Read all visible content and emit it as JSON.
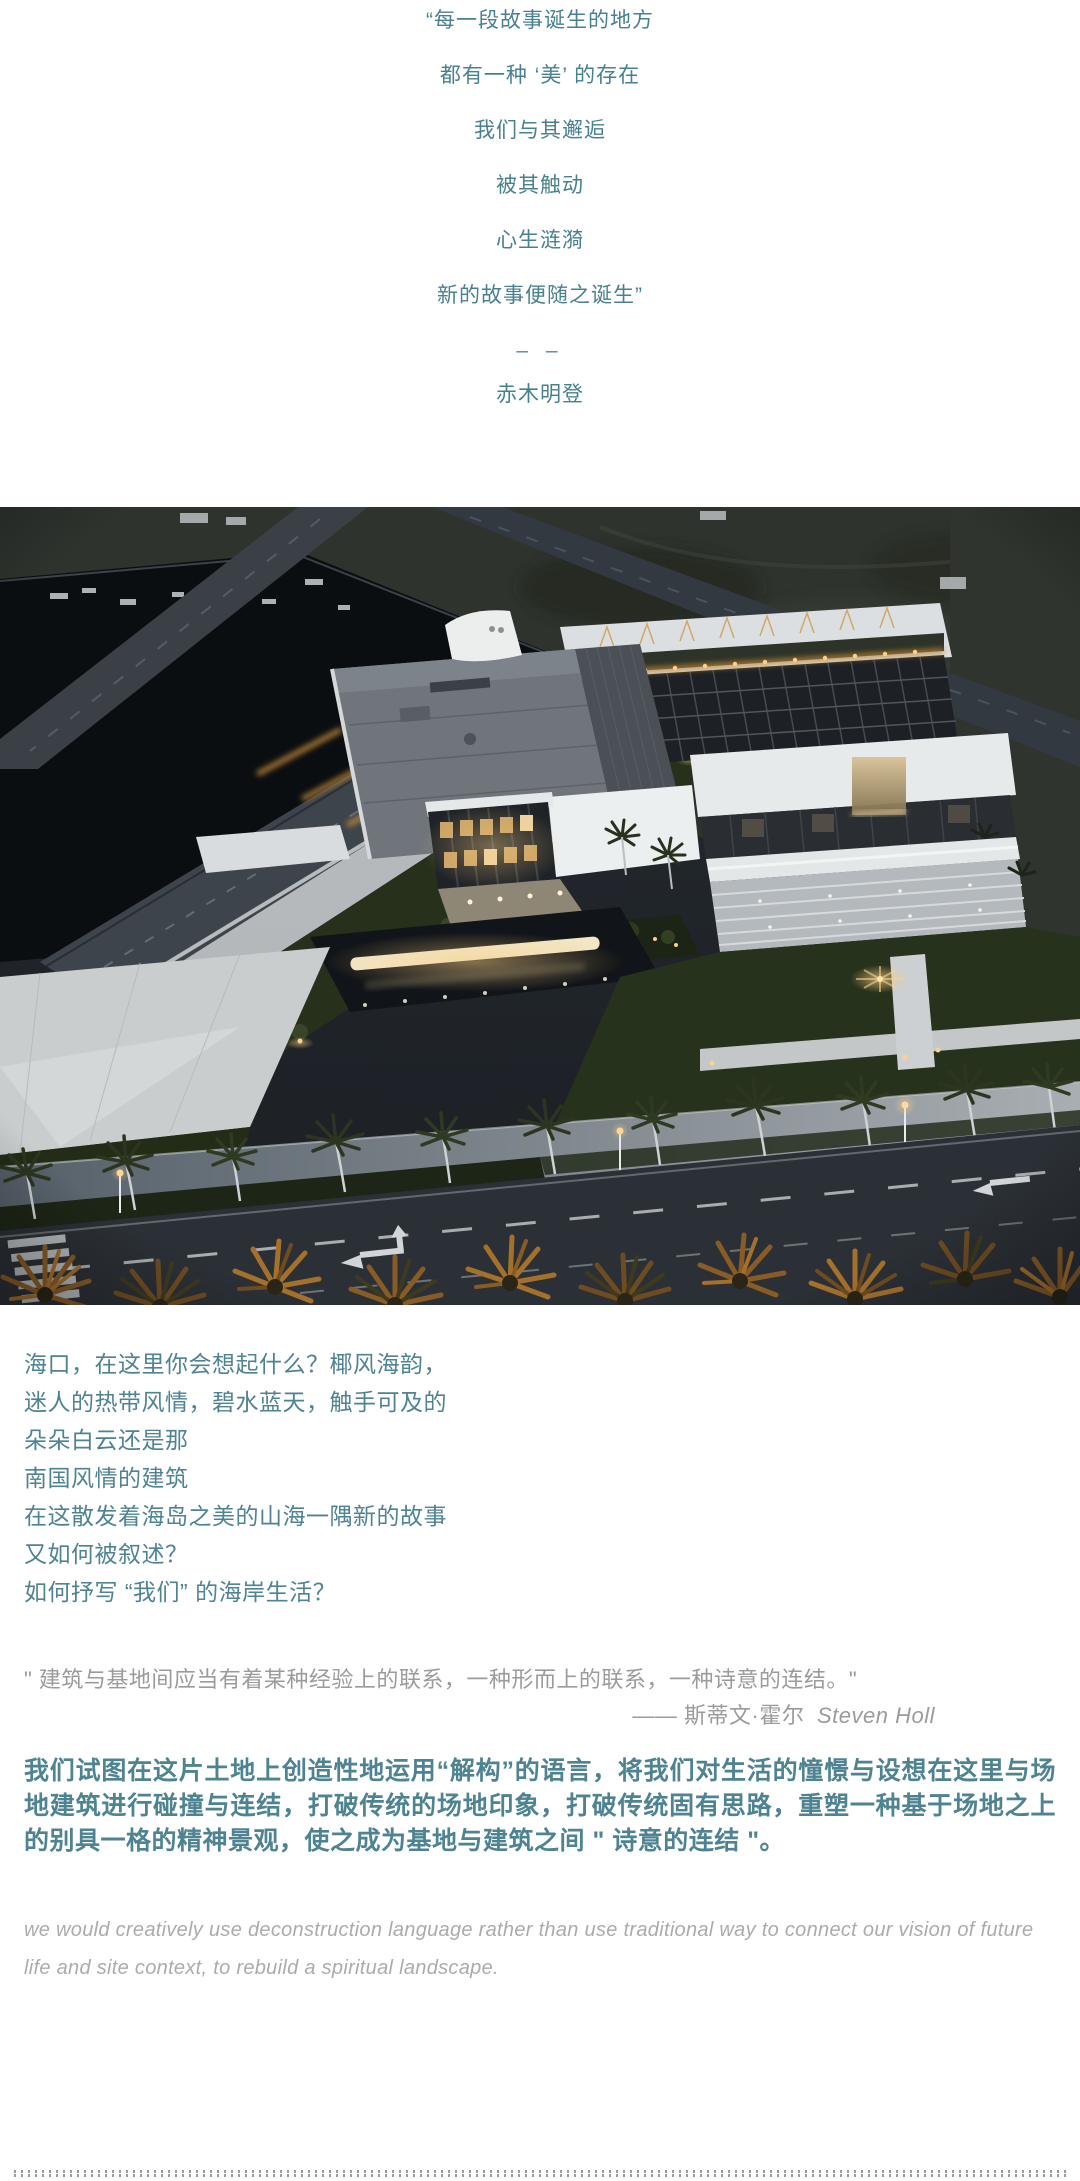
{
  "colors": {
    "poem_teal": "#47808F",
    "body_teal": "#4E8392",
    "quote_gray": "#9B9B9B",
    "english_gray": "#ABABAB",
    "background": "#ffffff"
  },
  "poem": {
    "lines": [
      "“每一段故事诞生的地方",
      "都有一种 ‘美’ 的存在",
      "我们与其邂逅",
      "被其触动",
      "心生涟漪",
      "新的故事便随之诞生”"
    ],
    "divider": "– –",
    "author": "赤木明登"
  },
  "intro": {
    "lines": [
      "海口，在这里你会想起什么？椰风海韵，",
      "迷人的热带风情，碧水蓝天，触手可及的",
      "朵朵白云还是那",
      "南国风情的建筑",
      "在这散发着海岛之美的山海一隅新的故事",
      "又如何被叙述？",
      "如何抒写 “我们” 的海岸生活？"
    ]
  },
  "holl_quote": {
    "text": "\" 建筑与基地间应当有着某种经验上的联系，一种形而上的联系，一种诗意的连结。\"",
    "attribution_zh": "—— 斯蒂文·霍尔",
    "attribution_en": "Steven Holl"
  },
  "concept": {
    "zh": "我们试图在这片土地上创造性地运用“解构”的语言，将我们对生活的憧憬与设想在这里与场地建筑进行碰撞与连结，打破传统的场地印象，打破传统固有思路，重塑一种基于场地之上的别具一格的精神景观，使之成为基地与建筑之间 \" 诗意的连结 \"。",
    "en": "we would creatively use deconstruction language rather than use traditional way to connect our vision of future life and site context, to rebuild a spiritual landscape."
  }
}
